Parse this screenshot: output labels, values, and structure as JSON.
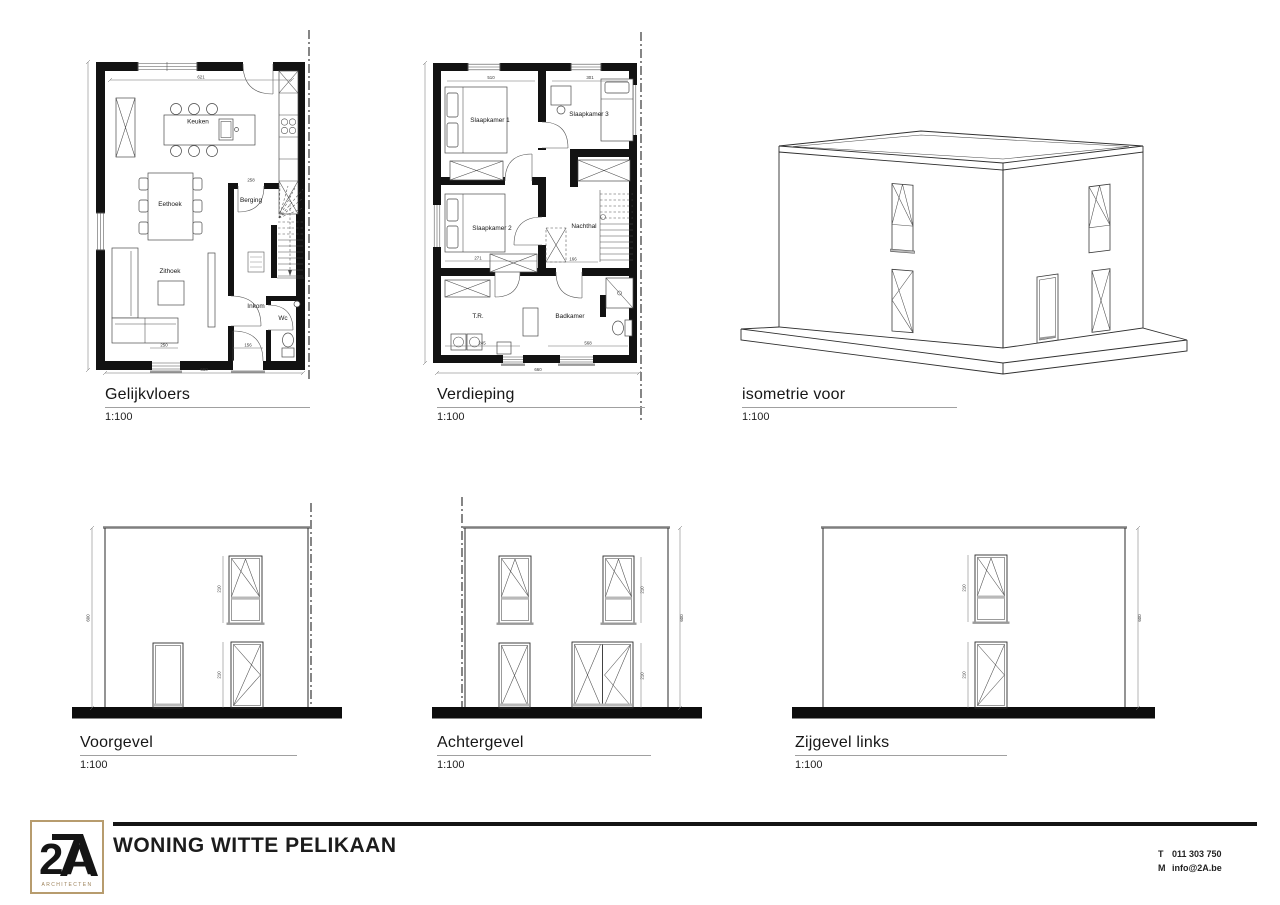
{
  "sheet": {
    "background": "#ffffff",
    "ink": "#1f1f1f",
    "gray_line": "#7f7f7f",
    "accent_tan": "#b79c6e"
  },
  "plans": {
    "gelijkvloers": {
      "title": "Gelijkvloers",
      "scale": "1:100",
      "rooms": {
        "keuken": "Keuken",
        "eethoek": "Eethoek",
        "zithoek": "Zithoek",
        "berging": "Berging",
        "inkom": "Inkom",
        "wc": "Wc"
      },
      "dims": {
        "width_top": "621",
        "berging_door": "258",
        "sofa": "250",
        "entry": "156",
        "width_bottom": "660"
      }
    },
    "verdieping": {
      "title": "Verdieping",
      "scale": "1:100",
      "rooms": {
        "slaapkamer1": "Slaapkamer 1",
        "slaapkamer2": "Slaapkamer 2",
        "slaapkamer3": "Slaapkamer 3",
        "nachthal": "Nachthal",
        "tr": "T.R.",
        "badkamer": "Badkamer"
      },
      "dims": {
        "sk1_width": "510",
        "sk3_width": "301",
        "sk2_width": "271",
        "nachthal_width": "166",
        "tr_width": "245",
        "badkamer_width": "568",
        "width_bottom": "660"
      }
    },
    "isometrie": {
      "title": "isometrie voor",
      "scale": "1:100"
    }
  },
  "elevations": {
    "voorgevel": {
      "title": "Voorgevel",
      "scale": "1:100",
      "dims": {
        "window_upper": "210",
        "window_lower": "210",
        "height": "600"
      }
    },
    "achtergevel": {
      "title": "Achtergevel",
      "scale": "1:100",
      "dims": {
        "window_upper": "210",
        "window_lower": "210",
        "height": "600"
      }
    },
    "zijgevel_links": {
      "title": "Zijgevel links",
      "scale": "1:100",
      "dims": {
        "window_upper": "210",
        "window_lower": "210",
        "height": "600"
      }
    }
  },
  "footer": {
    "logo_main": "2A",
    "logo_sub": "ARCHITECTEN",
    "project_title": "WONING WITTE PELIKAAN",
    "phone_label": "T",
    "phone": "011 303 750",
    "email_label": "M",
    "email": "info@2A.be"
  }
}
